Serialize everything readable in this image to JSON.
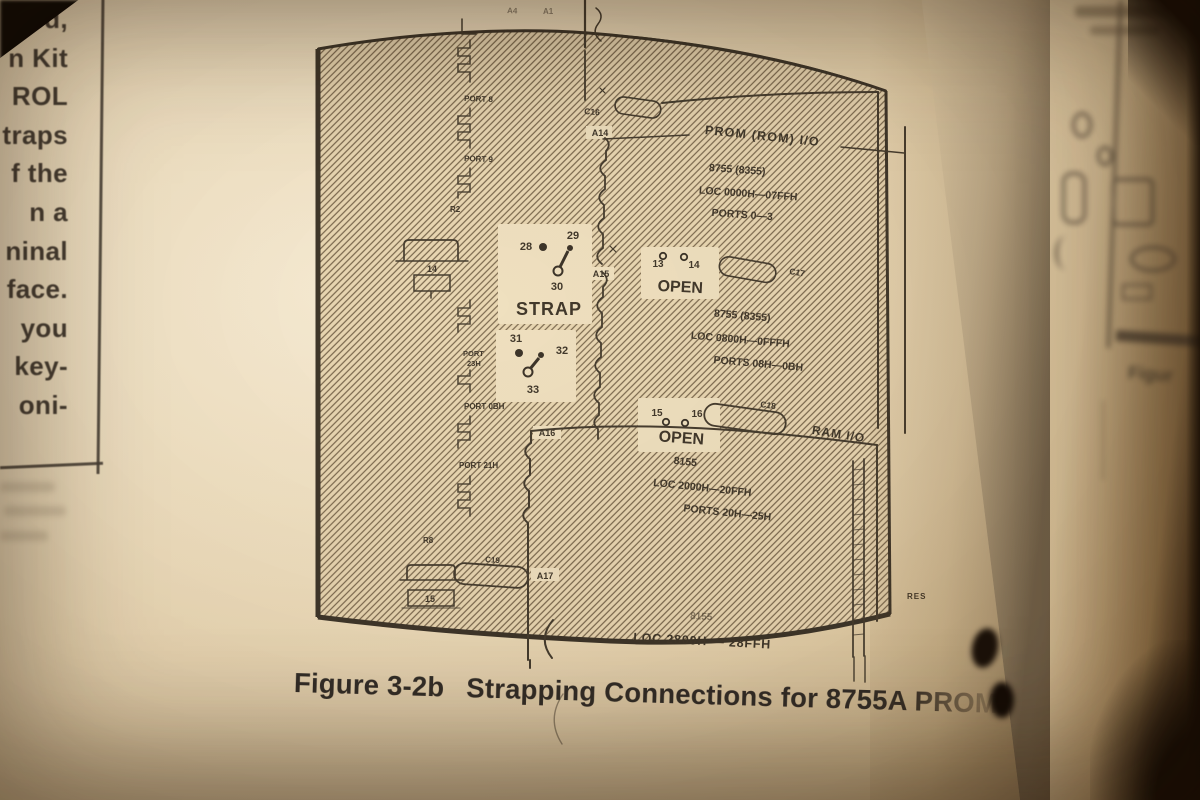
{
  "left_page": {
    "line_fragments": [
      "ved,",
      "n Kit",
      "ROL",
      "traps",
      "f the",
      "n a",
      "ninal",
      "face.",
      "you",
      "key-",
      "oni-"
    ]
  },
  "diagram": {
    "top_ref_left": "A4",
    "top_ref_right": "A1",
    "prom_title": "PROM (ROM) I/O",
    "ram_title": "RAM I/O",
    "c16": "C16",
    "c17": "C17",
    "c18": "C18",
    "a14": {
      "ref": "A14",
      "chip": "8755 (8355)",
      "loc": "LOC 0000H—07FFH",
      "ports": "PORTS 0—3"
    },
    "a15": {
      "ref": "A15",
      "chip": "8755 (8355)",
      "loc": "LOC 0800H—0FFFH",
      "ports": "PORTS 08H—0BH"
    },
    "a16": {
      "ref": "A16",
      "chip": "8155",
      "loc": "LOC 2000H—20FFH",
      "ports": "PORTS 20H—25H"
    },
    "a17": {
      "ref": "A17",
      "chip": "8155",
      "loc": "LOC 2800H — 28FFH"
    },
    "strap_label": "STRAP",
    "open_label": "OPEN",
    "strap1": {
      "p28": "28",
      "p29": "29",
      "p30": "30"
    },
    "strap2": {
      "p31": "31",
      "p32": "32",
      "p33": "33"
    },
    "jumper1": {
      "p13": "13",
      "p14": "14"
    },
    "jumper2": {
      "p15": "15",
      "p16": "16"
    },
    "left_labels": {
      "port_a": "PORT 8",
      "port_b": "PORT 9",
      "r2": "R2",
      "comp14": "14",
      "port_c1": "PORT",
      "port_c2": "23H",
      "port_d": "PORT 0BH",
      "port_e": "PORT 21H",
      "r8": "R8",
      "c19": "C19",
      "comp15": "15"
    },
    "res": "RES"
  },
  "caption": {
    "figure_no": "Figure 3-2b",
    "title": "Strapping Connections for 8755A PROM"
  },
  "facing_page": {
    "caption_fragment": "Figur"
  }
}
